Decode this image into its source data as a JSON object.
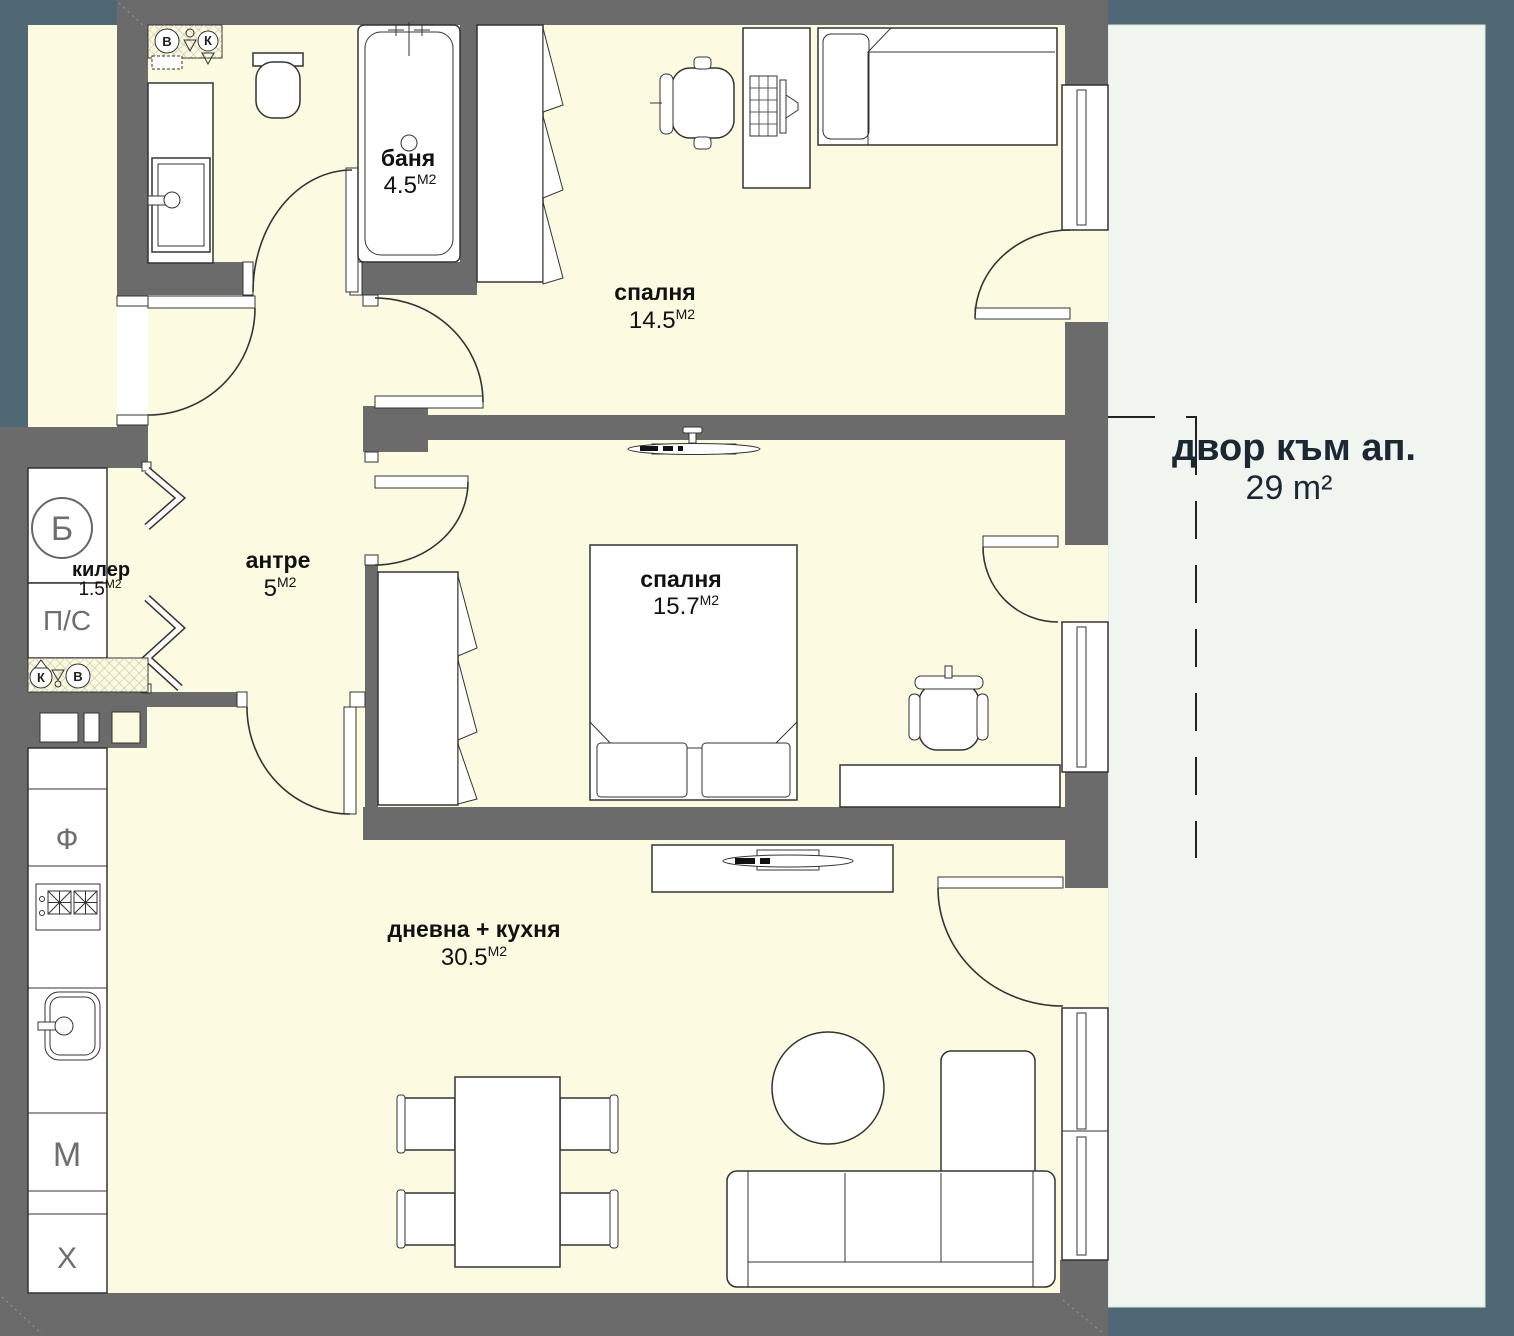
{
  "plan_title": "apartment floor plan",
  "palette": {
    "wall": "#6b6b6b",
    "floor": "#fcfbe2",
    "yard": "#f0f5ef",
    "outside": "#4e6874",
    "line": "#333333",
    "room_label": "#111111",
    "appliance_label": "#6e6e6e",
    "yard_label": "#1b2733"
  },
  "rooms": [
    {
      "id": "bathroom",
      "name": "баня",
      "area": "4.5",
      "unit": "М2"
    },
    {
      "id": "bedroom-1",
      "name": "спалня",
      "area": "14.5",
      "unit": "М2"
    },
    {
      "id": "bedroom-2",
      "name": "спалня",
      "area": "15.7",
      "unit": "М2"
    },
    {
      "id": "hallway",
      "name": "антре",
      "area": "5",
      "unit": "М2"
    },
    {
      "id": "closet",
      "name": "килер",
      "area": "1.5",
      "unit": "М2"
    },
    {
      "id": "living-kitchen",
      "name": "дневна + кухня",
      "area": "30.5",
      "unit": "М2"
    }
  ],
  "yard": {
    "name": "двор към ап.",
    "area": "29 m²"
  },
  "appliances": {
    "boiler": "Б",
    "washer_dryer": "П/С",
    "oven": "Ф",
    "dishwasher": "М",
    "fridge": "Х"
  },
  "risers": {
    "water": "В",
    "sewer": "К"
  }
}
